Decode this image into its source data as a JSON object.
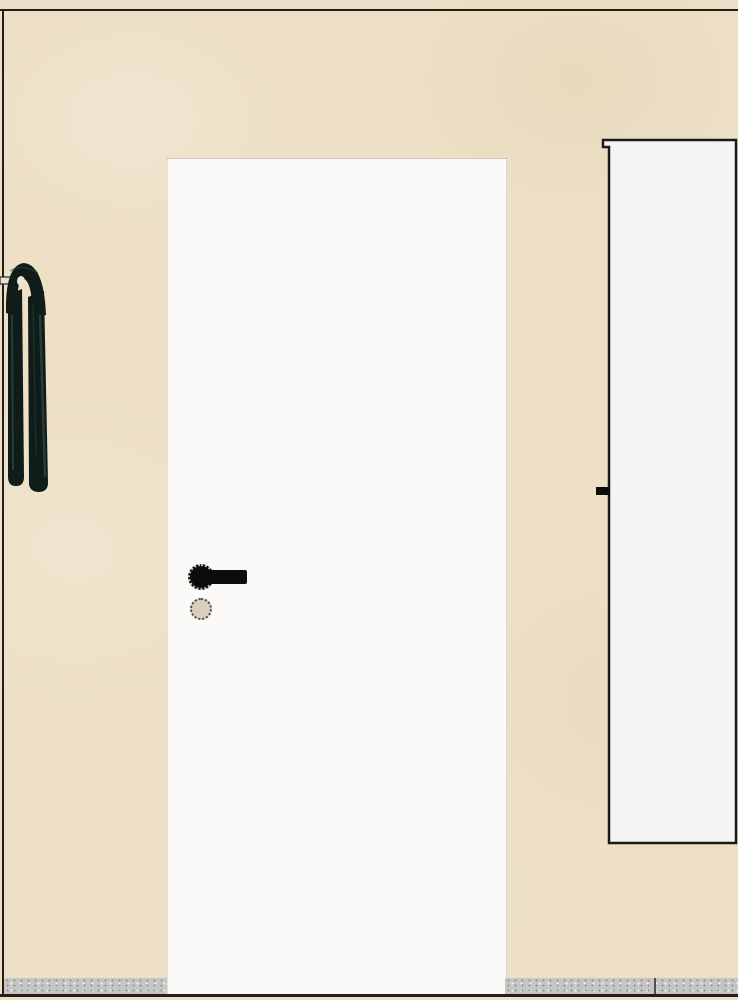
{
  "scene": {
    "description": "Interior elevation render: closed white door set in a beige plaster wall, black lever handle with round rose and keyhole escutcheon, dark towel hanging from a wall hook at the left wall corner, an open white door panel with edge handle at the right, speckled gray baseboard along the floor",
    "objects": {
      "wall": "beige plaster wall",
      "door": "closed white interior door",
      "door_handle": "black lever handle on round rose",
      "keyhole": "round keyhole escutcheon below handle",
      "towel": "dark green-black towel hanging on wall hook",
      "hook": "small wall hook bracket at left corner",
      "open_panel": "open white door panel with notched top corner and edge handle",
      "baseboard": "speckled gray baseboard with seam",
      "floor_line": "dark floor contour line"
    }
  },
  "colors": {
    "wall": "#EDE0C6",
    "door": "#FBFAF9",
    "panel": "#F4F4F2",
    "baseboard": "#C5C5C3",
    "outline": "#241E18",
    "handle": "#0C0C0C",
    "towel": "#101C1A",
    "towel-streak": "#2E4A45",
    "towel-highlight": "#ECE6D8",
    "hook": "#E6E0D2"
  }
}
